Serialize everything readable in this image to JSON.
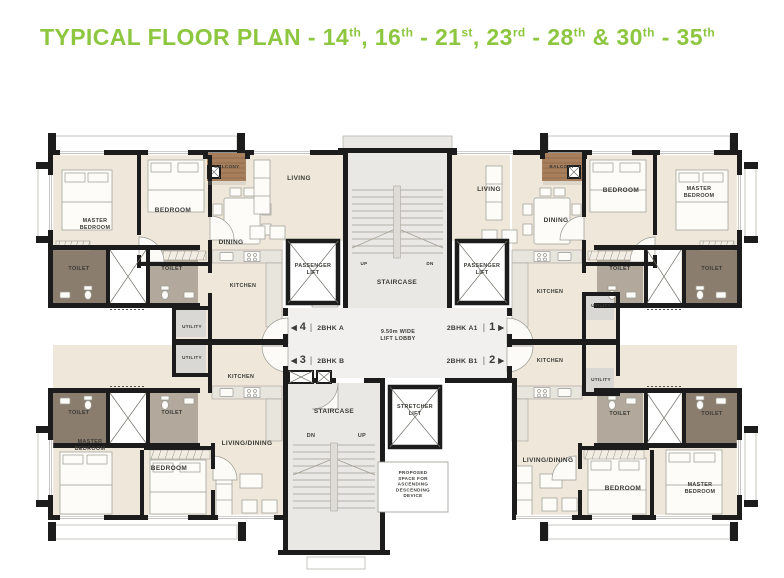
{
  "title": {
    "segments": [
      {
        "text": "TYPICAL FLOOR PLAN - 14"
      },
      {
        "text": "th",
        "sup": true
      },
      {
        "text": ", 16"
      },
      {
        "text": "th",
        "sup": true
      },
      {
        "text": " - 21"
      },
      {
        "text": "st",
        "sup": true
      },
      {
        "text": ", 23"
      },
      {
        "text": "rd",
        "sup": true
      },
      {
        "text": " - 28"
      },
      {
        "text": "th",
        "sup": true
      },
      {
        "text": " & 30"
      },
      {
        "text": "th",
        "sup": true
      },
      {
        "text": " - 35"
      },
      {
        "text": "th",
        "sup": true
      }
    ]
  },
  "plan": {
    "rooms": {
      "master_bedroom": "MASTER\nBEDROOM",
      "bedroom": "BEDROOM",
      "balcony": "BALCONY",
      "living": "LIVING",
      "dining": "DINING",
      "toilet": "TOILET",
      "kitchen": "KITCHEN",
      "utility": "UTILITY",
      "living_dining": "LIVING/DINING",
      "passenger_lift": "PASSENGER\nLIFT",
      "staircase": "STAIRCASE",
      "stretcher_lift": "STRETCHER\nLIFT",
      "lift_lobby": "9.50m WIDE\nLIFT LOBBY",
      "up": "UP",
      "dn": "DN",
      "proposed_device": "PROPOSED\nSPACE FOR\nASCENDING\nDESCENDING\nDEVICE"
    },
    "units": {
      "a": {
        "number": "4",
        "name": "2BHK A"
      },
      "b": {
        "number": "3",
        "name": "2BHK B"
      },
      "a1": {
        "number": "1",
        "name": "2BHK A1"
      },
      "b1": {
        "number": "2",
        "name": "2BHK B1"
      }
    },
    "icons": {
      "arrow_left": "◀",
      "arrow_right": "▶",
      "separator": "|"
    },
    "colors": {
      "accent_green": "#8dc63f",
      "wall": "#1c1c1c",
      "floor": "#efe8da",
      "toilet_dark": "#8b7d6e",
      "toilet_light": "#b2a89b",
      "balcony": "#a87f5c",
      "core": "#e9e8e4",
      "lobby": "#f1f0ee",
      "utility": "#d9d8d4",
      "line": "#9a9a94",
      "text": "#3a3a36"
    }
  }
}
